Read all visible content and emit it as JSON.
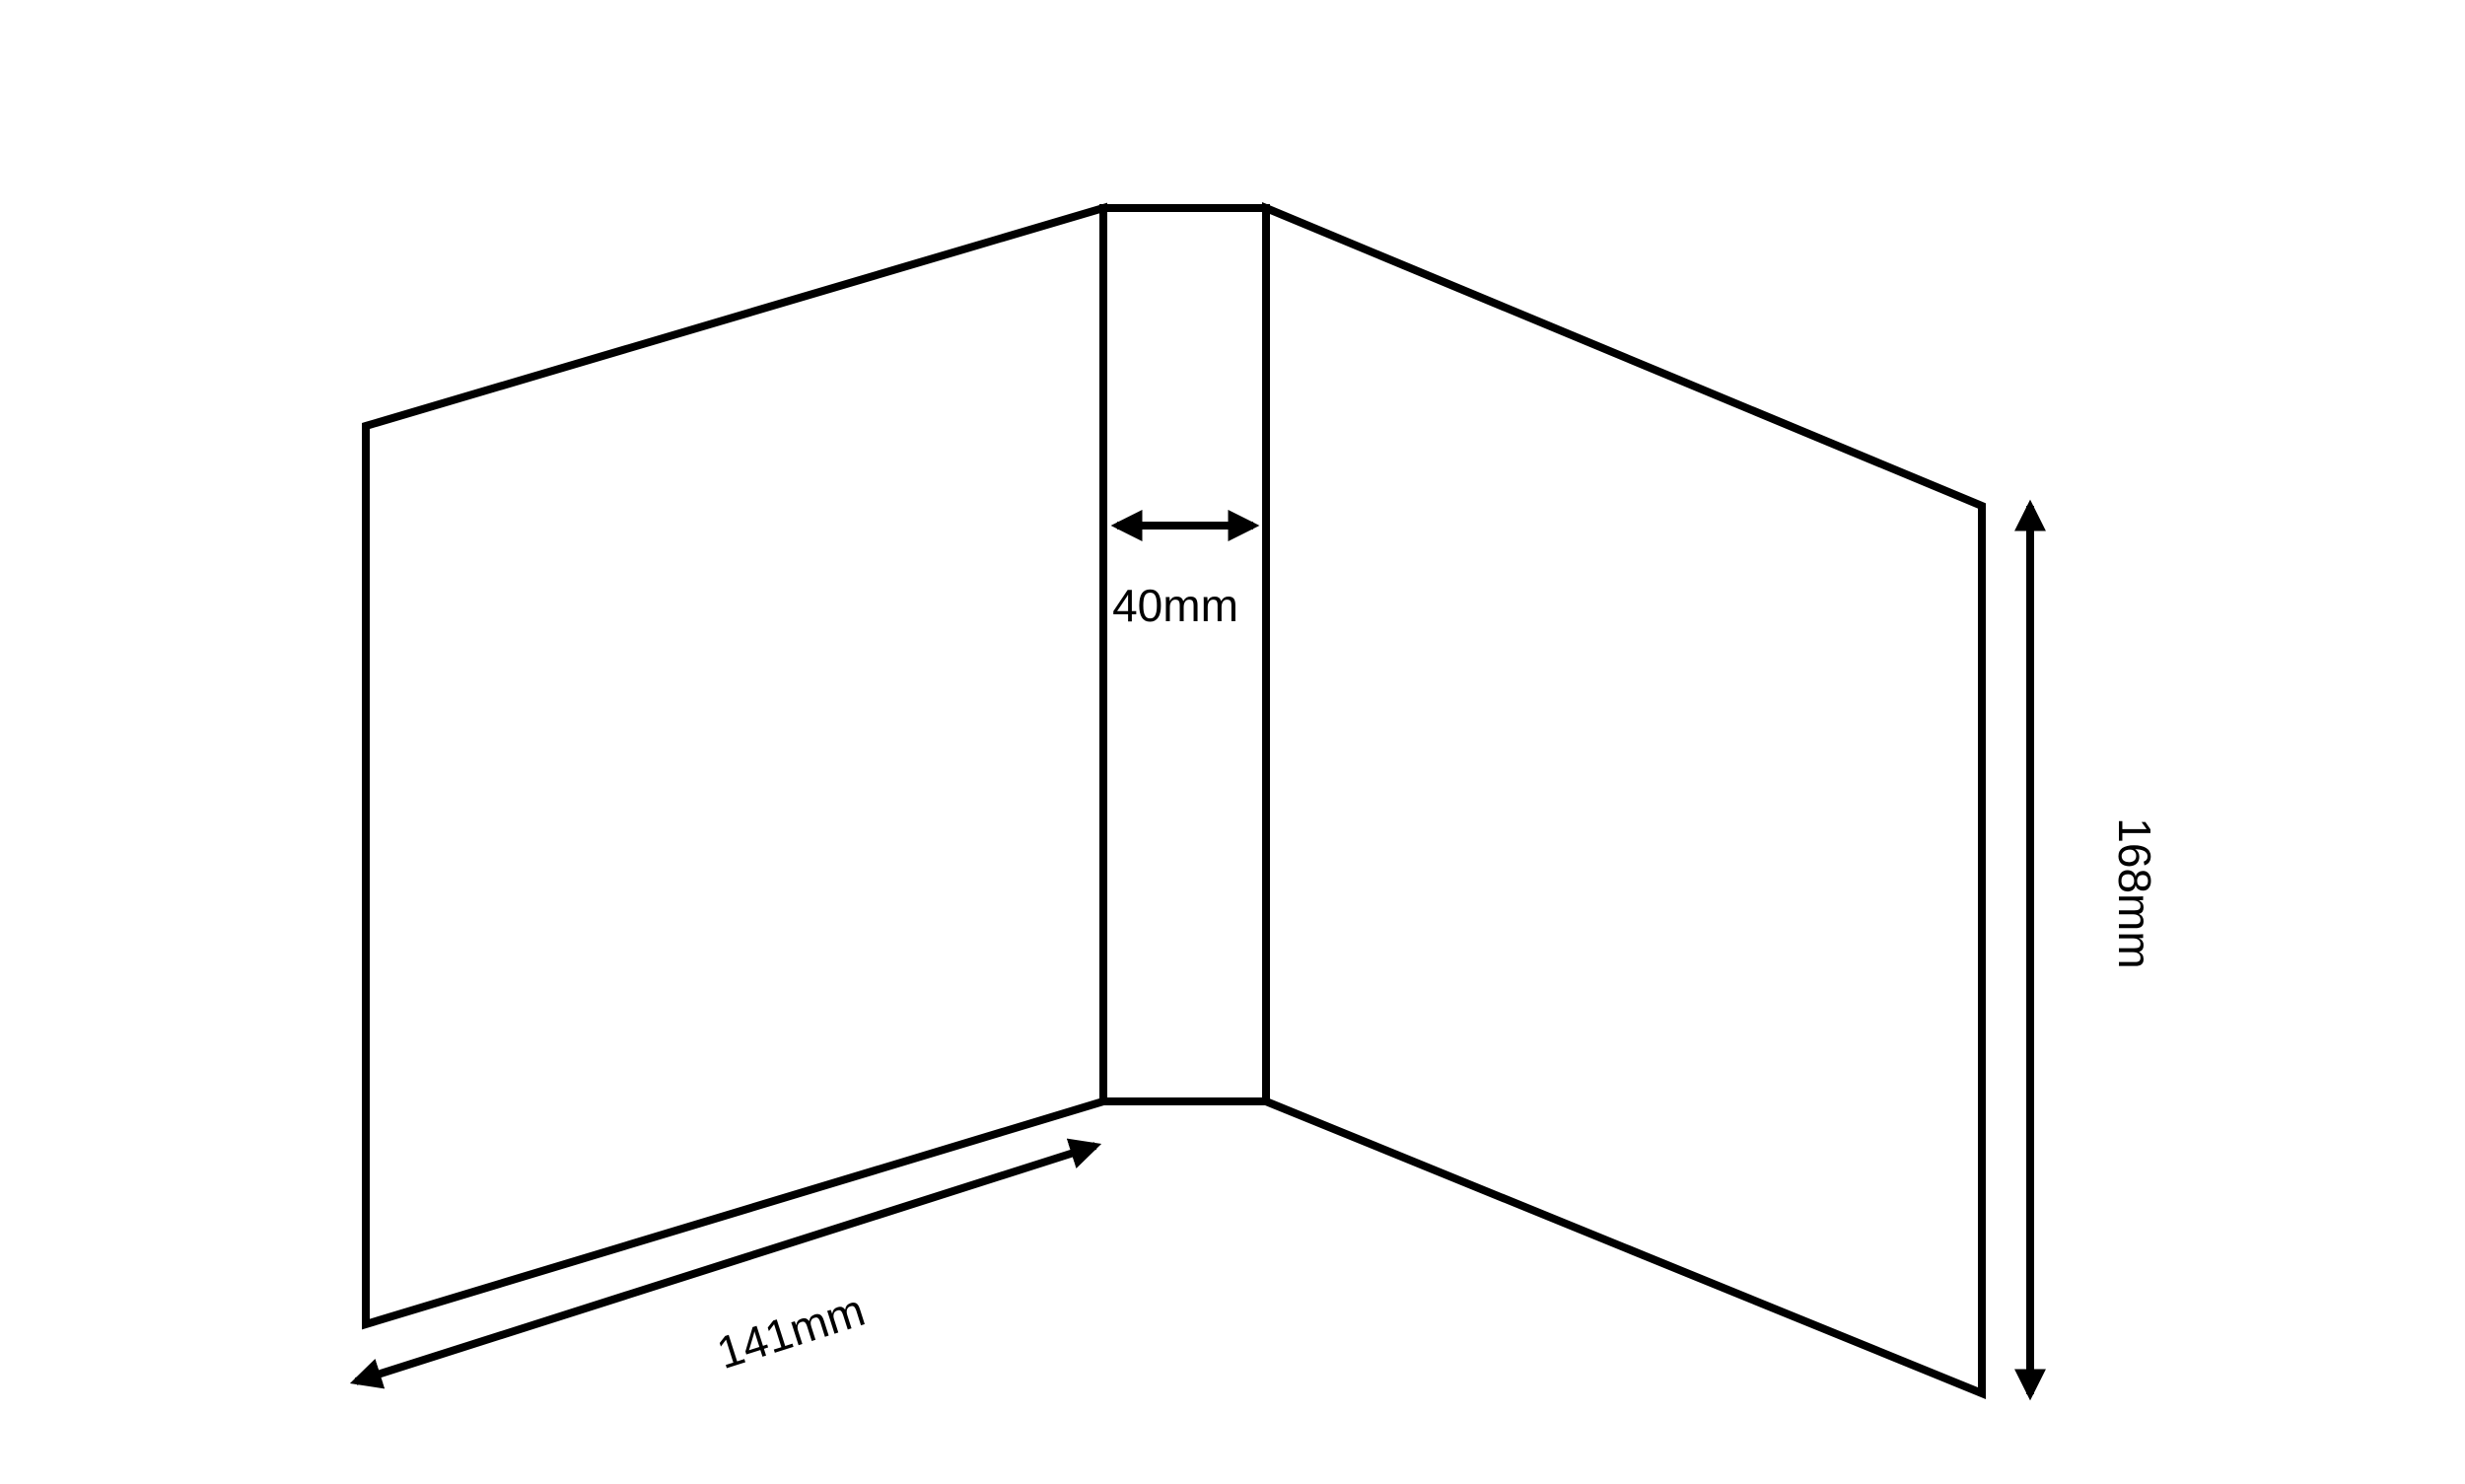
{
  "diagram": {
    "background_color": "#ffffff",
    "line_color": "#000000",
    "text_color": "#000000",
    "dimensions": {
      "spine_width": "40mm",
      "cover_width": "141mm",
      "cover_height": "168mm"
    }
  }
}
